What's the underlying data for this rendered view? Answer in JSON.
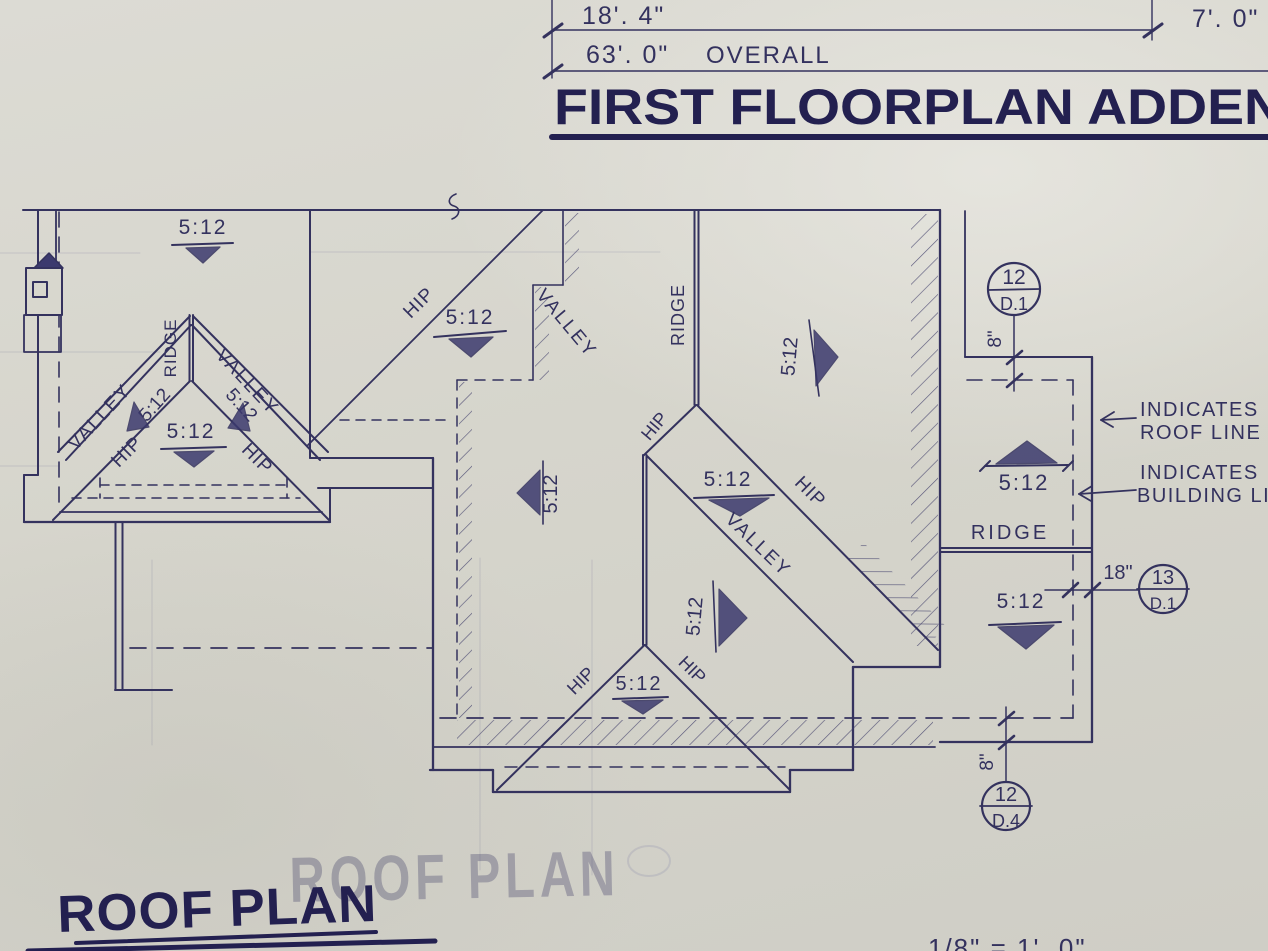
{
  "colors": {
    "paper": "#d8d7ce",
    "ink": "#34325e",
    "ink_heavy": "#232050",
    "shade": "#3c3a6e",
    "pencil": "#6b6b92"
  },
  "header": {
    "dim_left": "18'. 4\"",
    "dim_right": "7'. 0\"",
    "dim_overall_value": "63'. 0\"",
    "dim_overall_word": "OVERALL",
    "title": "FIRST FLOORPLAN ADDEN"
  },
  "labels": {
    "slope": "5:12",
    "hip": "HIP",
    "valley": "VALLEY",
    "ridge": "RIDGE"
  },
  "annotations": {
    "roof_line": [
      "INDICATES",
      "ROOF LINE"
    ],
    "building_line": [
      "INDICATES",
      "BUILDING LIN"
    ]
  },
  "details": {
    "top_right": {
      "number": "12",
      "sheet": "D.1"
    },
    "mid_right": {
      "number": "13",
      "sheet": "D.1"
    },
    "bottom": {
      "number": "12",
      "sheet": "D.4"
    }
  },
  "dimensions": {
    "eight_inches": "8\"",
    "eighteen_inches": "18\""
  },
  "footer": {
    "title": "ROOF PLAN",
    "scale": "1/8\" = 1'. 0\"",
    "watermark": "ROOF PLAN"
  }
}
